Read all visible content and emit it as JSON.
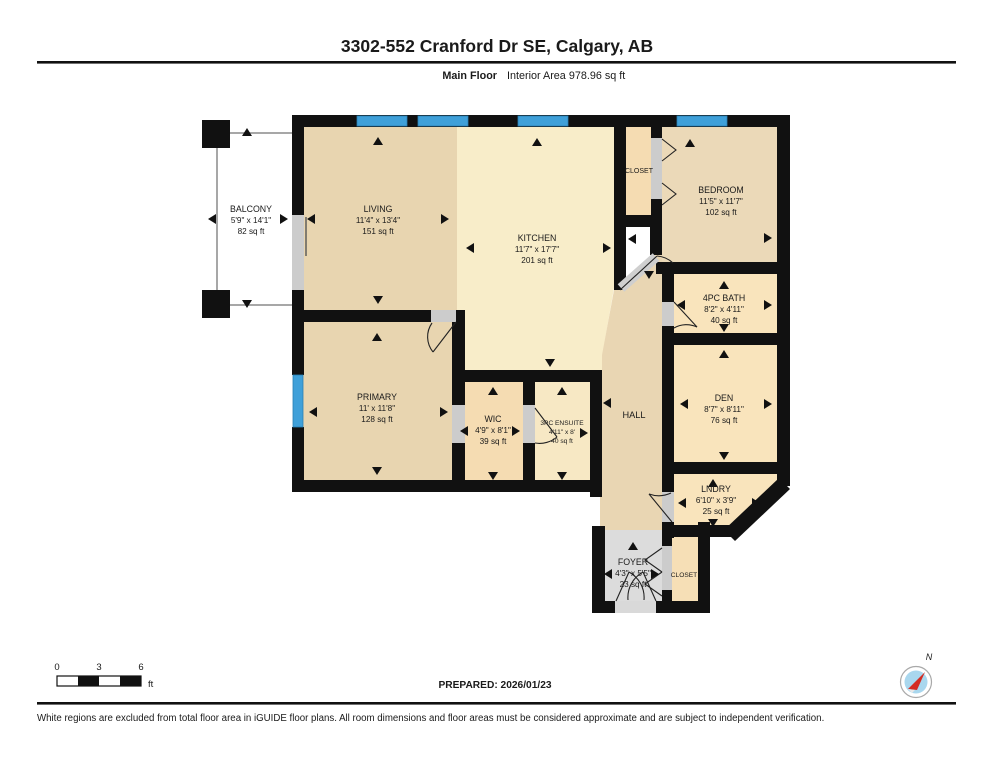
{
  "header": {
    "title": "3302-552 Cranford Dr SE, Calgary, AB",
    "floor_label": "Main Floor",
    "area_label": "Interior Area 978.96 sq ft"
  },
  "rooms": [
    {
      "id": "balcony",
      "name": "BALCONY",
      "dims": "5'9\" x 14'1\"",
      "area": "82 sq ft"
    },
    {
      "id": "living",
      "name": "LIVING",
      "dims": "11'4\" x 13'4\"",
      "area": "151 sq ft"
    },
    {
      "id": "kitchen",
      "name": "KITCHEN",
      "dims": "11'7\" x 17'7\"",
      "area": "201 sq ft"
    },
    {
      "id": "closet",
      "name": "CLOSET"
    },
    {
      "id": "bedroom",
      "name": "BEDROOM",
      "dims": "11'5\" x 11'7\"",
      "area": "102 sq ft"
    },
    {
      "id": "bath",
      "name": "4PC BATH",
      "dims": "8'2\" x 4'11\"",
      "area": "40 sq ft"
    },
    {
      "id": "den",
      "name": "DEN",
      "dims": "8'7\" x 8'11\"",
      "area": "76 sq ft"
    },
    {
      "id": "primary",
      "name": "PRIMARY",
      "dims": "11' x 11'8\"",
      "area": "128 sq ft"
    },
    {
      "id": "wic",
      "name": "WIC",
      "dims": "4'9\" x 8'1\"",
      "area": "39 sq ft"
    },
    {
      "id": "ensuite",
      "name": "3PC ENSUITE",
      "dims": "4'11\" x 8'",
      "area": "40 sq ft"
    },
    {
      "id": "hall",
      "name": "HALL"
    },
    {
      "id": "lndry",
      "name": "LNDRY",
      "dims": "6'10\" x 3'9\"",
      "area": "25 sq ft"
    },
    {
      "id": "foyer",
      "name": "FOYER",
      "dims": "4'3\" x 5'5\"",
      "area": "23 sq ft"
    },
    {
      "id": "closet2",
      "name": "CLOSET"
    }
  ],
  "footer": {
    "prepared": "PREPARED: 2026/01/23",
    "disclaimer": "White regions are excluded from total floor area in iGUIDE floor plans. All room dimensions and floor areas must be considered approximate and are subject to independent verification.",
    "scale_ticks": [
      "0",
      "3",
      "6"
    ],
    "scale_unit": "ft",
    "compass_label": "N"
  },
  "colors": {
    "wall": "#111111",
    "window": "#3fa0d9",
    "room_tan": "#e8d5b0",
    "room_cream": "#f8edc9",
    "room_peach": "#f5dcb2",
    "room_light": "#f9e4bc",
    "excluded_gray": "#dcdcdc",
    "door_gray": "#cccccc"
  }
}
